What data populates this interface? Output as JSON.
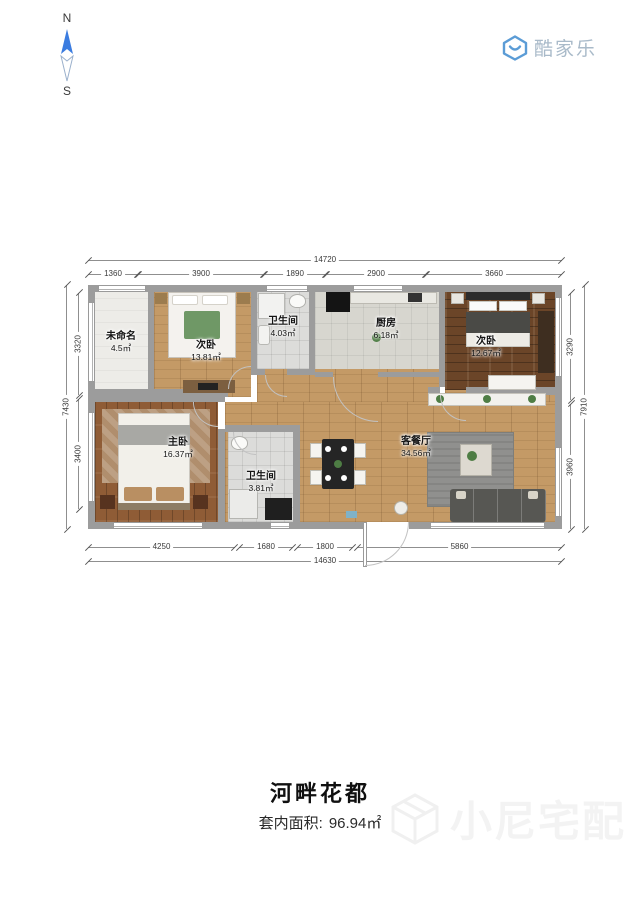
{
  "compass": {
    "north": "N",
    "south": "S"
  },
  "logo": {
    "brand": "酷家乐"
  },
  "plan": {
    "rooms": {
      "unnamed": {
        "name": "未命名",
        "area": "4.5㎡"
      },
      "bedroom_top": {
        "name": "次卧",
        "area": "13.81㎡"
      },
      "bath_top": {
        "name": "卫生间",
        "area": "4.03㎡"
      },
      "kitchen": {
        "name": "厨房",
        "area": "6.18㎡"
      },
      "bedroom_right": {
        "name": "次卧",
        "area": "12.67㎡"
      },
      "master": {
        "name": "主卧",
        "area": "16.37㎡"
      },
      "bath_bottom": {
        "name": "卫生间",
        "area": "3.81㎡"
      },
      "living": {
        "name": "客餐厅",
        "area": "34.56㎡"
      }
    },
    "dims": {
      "top": {
        "total": "14720",
        "segments": [
          "1360",
          "3900",
          "1890",
          "2900",
          "3660"
        ]
      },
      "bottom": {
        "total": "14630",
        "segments": [
          "4250",
          "1680",
          "1800",
          "5860"
        ]
      },
      "left": {
        "total": "7430",
        "segments": [
          "3320",
          "3400"
        ]
      },
      "right": {
        "total": "7910",
        "segments": [
          "3290",
          "3960"
        ]
      }
    }
  },
  "footer": {
    "title": "河畔花都",
    "area_label": "套内面积:",
    "area_value": "96.94㎡"
  },
  "watermark": {
    "text": "小尼宅配"
  },
  "colors": {
    "compass_blue": "#3b7ce0",
    "logo_blue": "#5b9cd6",
    "logo_text_gray": "#a9bac9",
    "wall_gray": "#9c9c9c",
    "wood_light": "#c49a66",
    "wood_dark": "#6b4528",
    "wood_master": "#8f5c36",
    "tile_gray": "#dcdcda",
    "watermark_gray": "#f3f3f3"
  }
}
